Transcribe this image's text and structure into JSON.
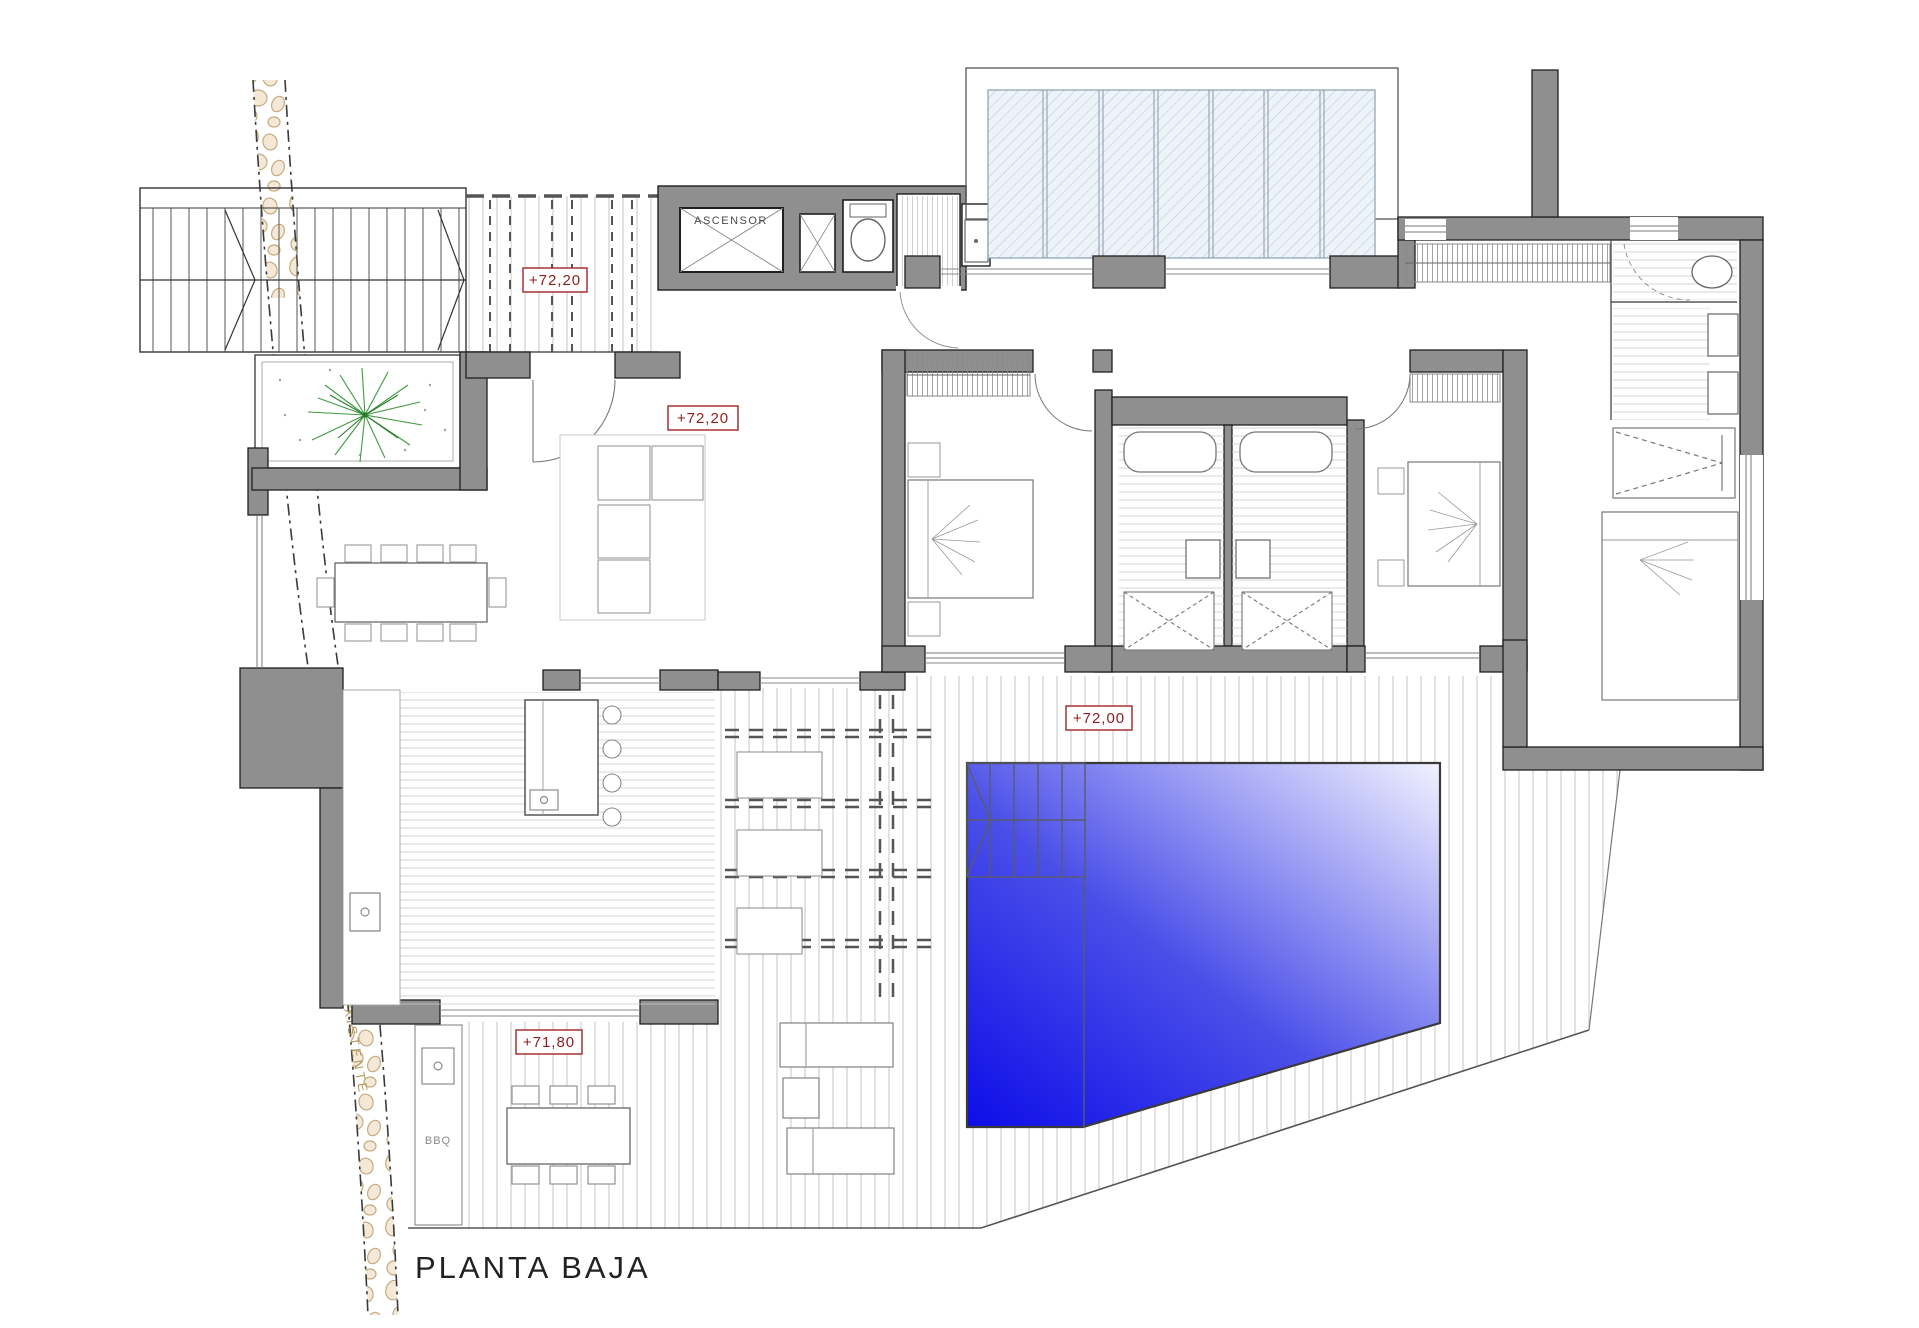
{
  "plan": {
    "title": "PLANTA BAJA",
    "labels": {
      "elevator": "ASCENSOR",
      "existing_wall": "MURO EXISTENTE",
      "bbq": "BBQ"
    },
    "levels": {
      "entry_porch": "+72,20",
      "living_room": "+72,20",
      "pool_deck": "+72,00",
      "bbq_terrace": "+71,80"
    },
    "colors": {
      "wall": "#8f8f8f",
      "wall_outline": "#1f1f1f",
      "level_marker_border": "#a83232",
      "level_marker_text": "#8e1d1d",
      "pool_deep": "#0d0de8",
      "pool_shallow": "#f2f2ff",
      "glass_hatch": "#b3c6d8",
      "stone_wall": "#c6a97e",
      "palm_tree": "#3f9b3f"
    }
  }
}
